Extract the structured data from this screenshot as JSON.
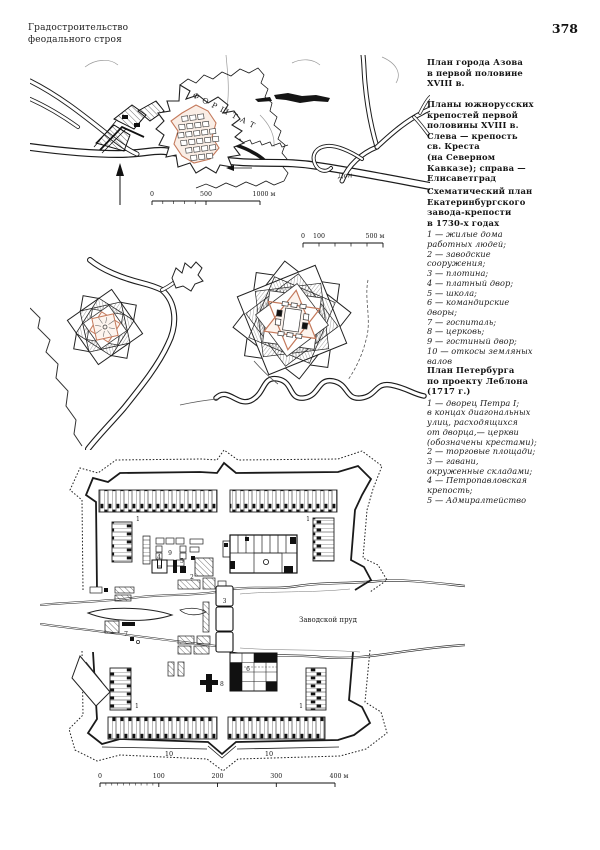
{
  "header": {
    "running_title": "Градостроительство\nфеодального строя",
    "page_number": "378"
  },
  "captions": {
    "azov": {
      "title": "План города Азова\nв первой половине\nXVIII в."
    },
    "south_forts": {
      "title": "Планы южнорусских\nкрепостей первой\nполовины XVIII в.\nСлева — крепость\nсв. Креста\n(на Северном\nКавказе); справа —\nЕлисаветград"
    },
    "ekaterinburg": {
      "title": "Схематический план\nЕкатеринбургского\nзавода-крепости\nв 1730-х годах",
      "legend": "1 — жилые дома\nработных людей;\n2 — заводские\nсооружения;\n3 — плотина;\n4 — платный двор;\n5 — школа;\n6 — командирские\nдворы;\n7 — госпиталь;\n8 — церковь;\n9 — гостиный двор;\n10 — откосы земляных\nвалов"
    },
    "petersburg": {
      "title": "План Петербурга\nпо проекту Леблона\n(1717 г.)",
      "legend": "1 — дворец Петра I;\nв концах диагональных\nулиц, расходящихся\nот дворца,— церкви\n(обозначены крестами);\n2 — торговые площади;\n3 — гавани,\nокруженные складами;\n4 — Петропавловская\nкрепость;\n5 — Адмиралтейство"
    }
  },
  "azov_map": {
    "forstadt_label": "ФОРШТАТ",
    "river_label": "Дон",
    "scale": {
      "t0": "0",
      "t500": "500",
      "t1000": "1000 м"
    }
  },
  "forts_map": {
    "scale": {
      "t0": "0",
      "t100": "100",
      "t500": "500 м"
    }
  },
  "ekb_map": {
    "pond_label": "Заводской пруд",
    "numbers": [
      "1",
      "2",
      "3",
      "4",
      "5",
      "6",
      "7",
      "8",
      "9",
      "10"
    ],
    "scale": {
      "t0": "0",
      "t100": "100",
      "t200": "200",
      "t300": "300",
      "t400": "400 м"
    }
  },
  "colors": {
    "ink": "#1a1a1a",
    "fort_accent": "#c4795b",
    "paper": "#ffffff"
  }
}
